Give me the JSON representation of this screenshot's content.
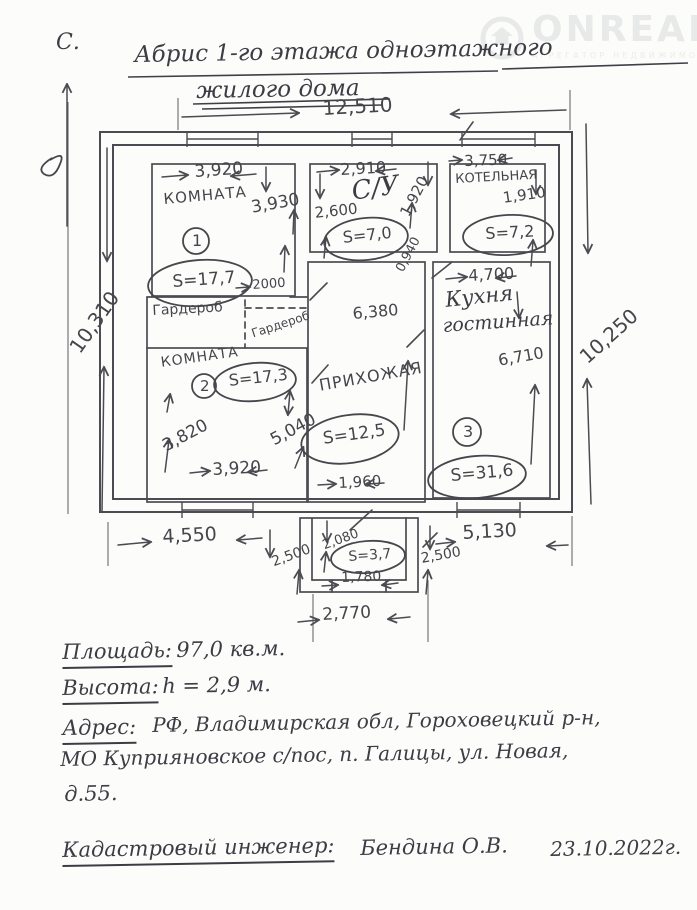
{
  "north": {
    "label": "С."
  },
  "watermark": {
    "brand": "ONREALT",
    "subtext": "АГРЕГАТОР НЕДВИЖИМОСТИ"
  },
  "title": {
    "line1": "Абрис 1-го этажа одноэтажного",
    "line2": "жилого дома"
  },
  "plan": {
    "overall": {
      "width_top": "12,510",
      "height_left": "10,310",
      "height_right": "10,250"
    },
    "bottom_dims": {
      "left": "4,550",
      "right": "5,130"
    },
    "rooms": {
      "room1": {
        "name": "КОМНАТА",
        "number": "1",
        "area": "S=17,7",
        "dims": {
          "top": "3,920",
          "right": "3,930",
          "door": "2000"
        }
      },
      "wardrobe1": {
        "name": "Гардероб"
      },
      "wardrobe2": {
        "name": "Гардероб"
      },
      "bathroom": {
        "name": "С/У",
        "area": "S=7,0",
        "dims": {
          "top": "2,910",
          "left": "2,600",
          "right": "1,920",
          "extra": "0,940"
        }
      },
      "boiler": {
        "name": "КОТЕЛЬНАЯ",
        "area": "S=7,2",
        "dims": {
          "top": "3,750",
          "right": "1,910"
        }
      },
      "kitchen": {
        "name_line1": "Кухня",
        "name_line2": "гостинная",
        "number": "3",
        "area": "S=31,6",
        "dims": {
          "top": "4,700",
          "right": "6,710"
        }
      },
      "hall": {
        "name": "ПРИХОЖАЯ",
        "area": "S=12,5",
        "dims": {
          "top": "6,380",
          "bottom": "1,960"
        }
      },
      "room2": {
        "name": "КОМНАТА",
        "number": "2",
        "area": "S=17,3",
        "dims": {
          "left": "3,820",
          "right": "5,040",
          "bottom": "3,920"
        }
      },
      "porch": {
        "area": "S=3,7",
        "dims": {
          "left_outer": "2,500",
          "left_inner": "2,080",
          "right": "2,500",
          "inner_bottom": "1,780",
          "bottom": "2,770"
        }
      }
    }
  },
  "notes": {
    "area_label": "Площадь:",
    "area_value": "97,0 кв.м.",
    "height_label": "Высота:",
    "height_value": "h = 2,9 м.",
    "address_label": "Адрес:",
    "address_line1": "РФ, Владимирская обл, Гороховецкий р-н,",
    "address_line2": "МО Куприяновское с/пос, п. Галицы, ул. Новая,",
    "address_line3": "д.55.",
    "engineer_label": "Кадастровый инженер:",
    "engineer_name": "Бендина О.В.",
    "date": "23.10.2022г."
  }
}
